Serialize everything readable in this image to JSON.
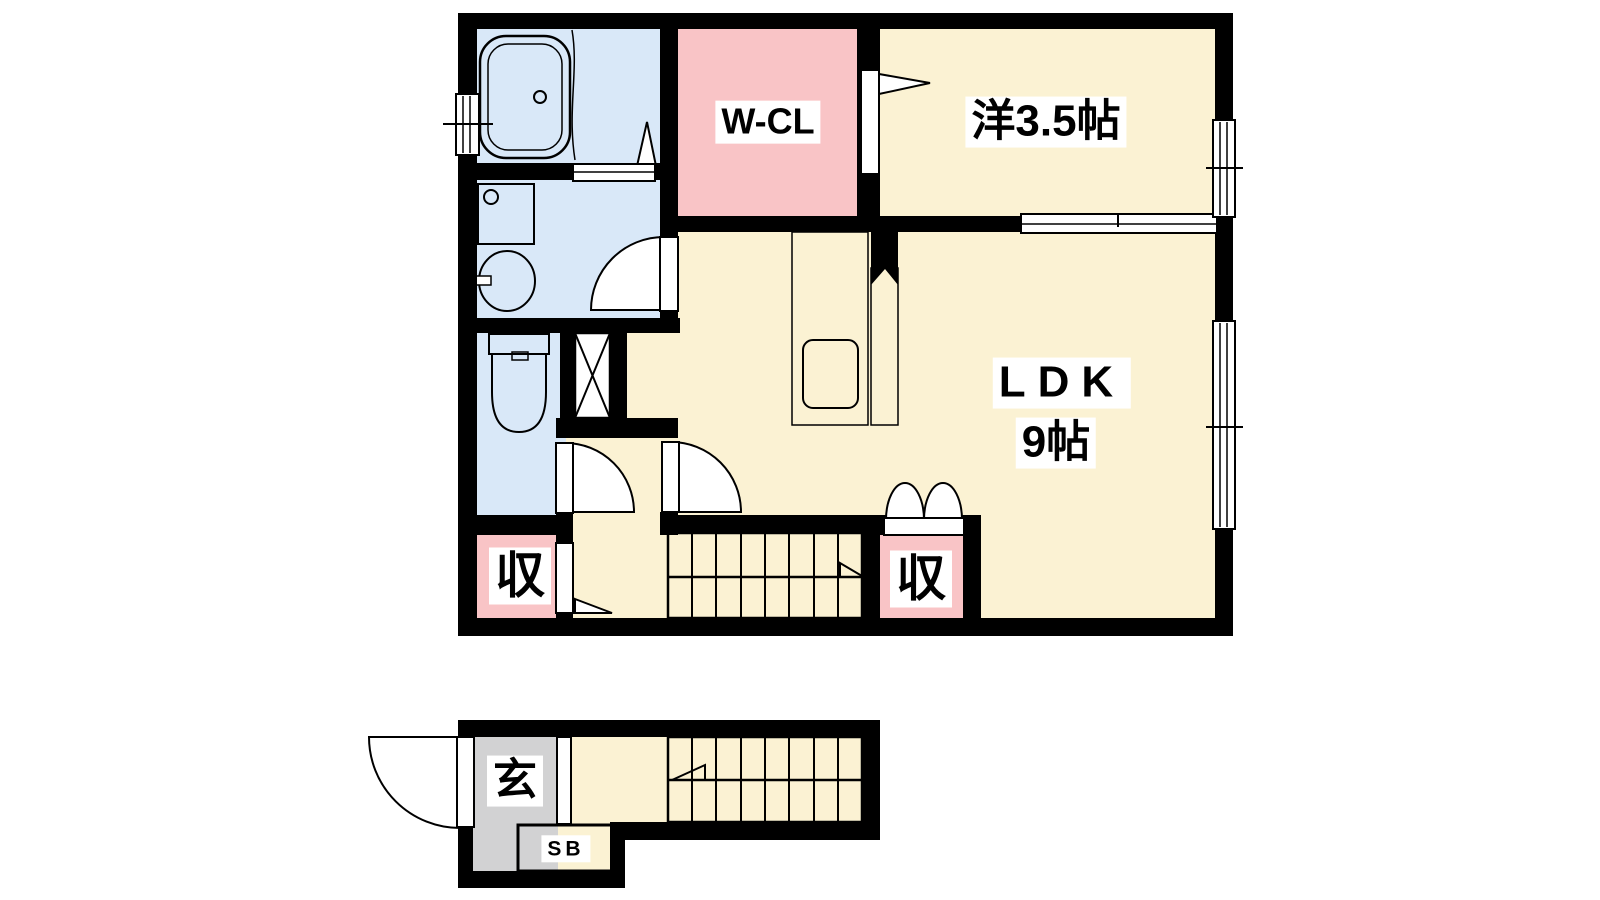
{
  "labels": {
    "walk_in_closet": "W-CL",
    "western_room": "洋3.5帖",
    "ldk": "LDK",
    "ldk_size": "9帖",
    "storage_upper_left": "収",
    "storage_upper_right": "収",
    "entrance": "玄",
    "shoe_box": "SB"
  },
  "colors": {
    "background": "#ffffff",
    "wall": "#000000",
    "line": "#000000",
    "cream": "#fbf2d3",
    "pink": "#f9c4c6",
    "blue": "#d9e8f8",
    "purple": "#e7ddf2",
    "gray": "#d2d2d3",
    "stairs": "#e8dcc3",
    "counter": "#e5d2ae"
  }
}
